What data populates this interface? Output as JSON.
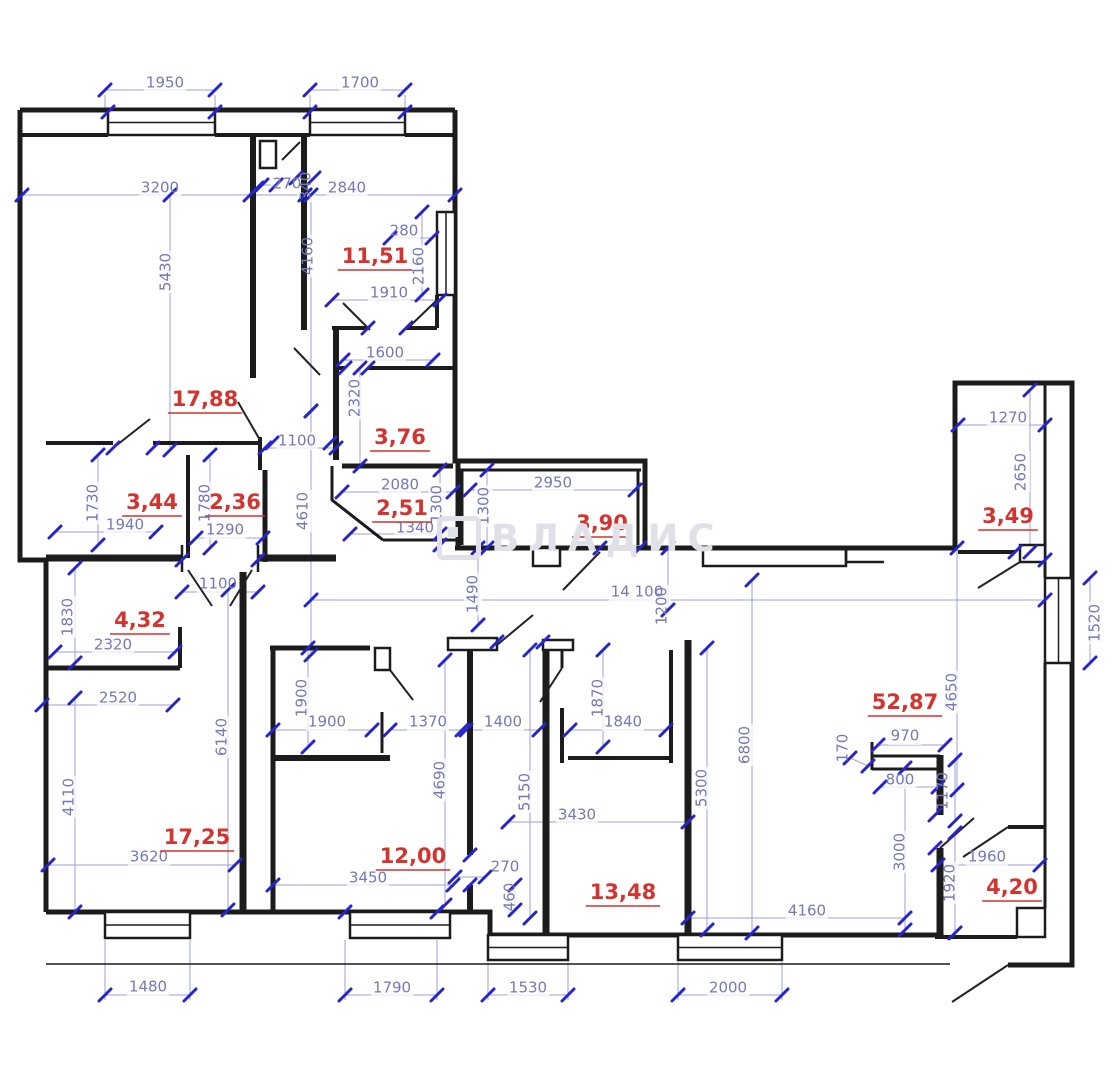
{
  "meta": {
    "watermark": "ВЛАДИС"
  },
  "plan": {
    "colors": {
      "wall": "#1c1c1c",
      "dim_line": "#9aa0d6",
      "tick": "#2525cb",
      "dim_text": "#7478b8",
      "area_text": "#d2342f",
      "watermark": "#dfe0e8"
    },
    "area_labels": [
      {
        "t": "17,88",
        "x": 205,
        "y": 400
      },
      {
        "t": "11,51",
        "x": 375,
        "y": 257
      },
      {
        "t": "3,76",
        "x": 400,
        "y": 438
      },
      {
        "t": "2,51",
        "x": 402,
        "y": 509
      },
      {
        "t": "3,90",
        "x": 602,
        "y": 524
      },
      {
        "t": "3,44",
        "x": 152,
        "y": 503
      },
      {
        "t": "2,36",
        "x": 235,
        "y": 503
      },
      {
        "t": "3,49",
        "x": 1008,
        "y": 517
      },
      {
        "t": "4,32",
        "x": 140,
        "y": 621
      },
      {
        "t": "17,25",
        "x": 197,
        "y": 838
      },
      {
        "t": "12,00",
        "x": 413,
        "y": 857
      },
      {
        "t": "13,48",
        "x": 623,
        "y": 893
      },
      {
        "t": "52,87",
        "x": 905,
        "y": 703
      },
      {
        "t": "4,20",
        "x": 1012,
        "y": 888
      }
    ],
    "dim_labels": [
      {
        "t": "1950",
        "x": 165,
        "y": 83,
        "r": 0
      },
      {
        "t": "1700",
        "x": 360,
        "y": 83,
        "r": 0
      },
      {
        "t": "3200",
        "x": 160,
        "y": 188,
        "r": 0
      },
      {
        "t": "270",
        "x": 287,
        "y": 184,
        "r": 0
      },
      {
        "t": "340",
        "x": 306,
        "y": 186,
        "r": -90
      },
      {
        "t": "2840",
        "x": 347,
        "y": 188,
        "r": 0
      },
      {
        "t": "280",
        "x": 404,
        "y": 231,
        "r": 0
      },
      {
        "t": "2160",
        "x": 419,
        "y": 266,
        "r": -90
      },
      {
        "t": "1910",
        "x": 389,
        "y": 293,
        "r": 0
      },
      {
        "t": "5430",
        "x": 166,
        "y": 272,
        "r": -90
      },
      {
        "t": "4160",
        "x": 308,
        "y": 256,
        "r": -90
      },
      {
        "t": "1600",
        "x": 385,
        "y": 353,
        "r": 0
      },
      {
        "t": "2320",
        "x": 355,
        "y": 398,
        "r": -90
      },
      {
        "t": "1100",
        "x": 297,
        "y": 441,
        "r": 0
      },
      {
        "t": "4610",
        "x": 303,
        "y": 511,
        "r": -90
      },
      {
        "t": "2080",
        "x": 400,
        "y": 485,
        "r": 0
      },
      {
        "t": "1300",
        "x": 437,
        "y": 504,
        "r": -90
      },
      {
        "t": "1300",
        "x": 484,
        "y": 506,
        "r": -90
      },
      {
        "t": "1340",
        "x": 415,
        "y": 528,
        "r": 0
      },
      {
        "t": "2950",
        "x": 553,
        "y": 483,
        "r": 0
      },
      {
        "t": "1270",
        "x": 1008,
        "y": 418,
        "r": 0
      },
      {
        "t": "2650",
        "x": 1021,
        "y": 472,
        "r": -90
      },
      {
        "t": "14 100",
        "x": 637,
        "y": 592,
        "r": 0
      },
      {
        "t": "1200",
        "x": 662,
        "y": 606,
        "r": -90
      },
      {
        "t": "1520",
        "x": 1095,
        "y": 623,
        "r": -90
      },
      {
        "t": "1100",
        "x": 218,
        "y": 584,
        "r": 0
      },
      {
        "t": "1490",
        "x": 473,
        "y": 594,
        "r": -90
      },
      {
        "t": "1830",
        "x": 68,
        "y": 617,
        "r": -90
      },
      {
        "t": "2320",
        "x": 113,
        "y": 645,
        "r": 0
      },
      {
        "t": "2520",
        "x": 118,
        "y": 698,
        "r": 0
      },
      {
        "t": "6140",
        "x": 222,
        "y": 737,
        "r": -90
      },
      {
        "t": "4110",
        "x": 69,
        "y": 797,
        "r": -90
      },
      {
        "t": "3620",
        "x": 149,
        "y": 857,
        "r": 0
      },
      {
        "t": "1480",
        "x": 148,
        "y": 987,
        "r": 0
      },
      {
        "t": "1900",
        "x": 302,
        "y": 698,
        "r": -90
      },
      {
        "t": "1900",
        "x": 327,
        "y": 722,
        "r": 0
      },
      {
        "t": "1370",
        "x": 428,
        "y": 722,
        "r": 0
      },
      {
        "t": "1400",
        "x": 503,
        "y": 722,
        "r": 0
      },
      {
        "t": "4690",
        "x": 440,
        "y": 780,
        "r": -90
      },
      {
        "t": "3450",
        "x": 368,
        "y": 878,
        "r": 0
      },
      {
        "t": "270",
        "x": 505,
        "y": 867,
        "r": 0
      },
      {
        "t": "460",
        "x": 510,
        "y": 897,
        "r": -90
      },
      {
        "t": "1870",
        "x": 598,
        "y": 698,
        "r": -90
      },
      {
        "t": "1840",
        "x": 623,
        "y": 722,
        "r": 0
      },
      {
        "t": "5150",
        "x": 525,
        "y": 792,
        "r": -90
      },
      {
        "t": "3430",
        "x": 577,
        "y": 815,
        "r": 0
      },
      {
        "t": "5300",
        "x": 702,
        "y": 788,
        "r": -90
      },
      {
        "t": "6800",
        "x": 745,
        "y": 745,
        "r": -90
      },
      {
        "t": "4650",
        "x": 952,
        "y": 692,
        "r": -90
      },
      {
        "t": "970",
        "x": 905,
        "y": 736,
        "r": 0
      },
      {
        "t": "170",
        "x": 843,
        "y": 748,
        "r": -90
      },
      {
        "t": "800",
        "x": 900,
        "y": 780,
        "r": 0
      },
      {
        "t": "1170",
        "x": 943,
        "y": 791,
        "r": -90
      },
      {
        "t": "3000",
        "x": 900,
        "y": 852,
        "r": -90
      },
      {
        "t": "1920",
        "x": 950,
        "y": 883,
        "r": -90
      },
      {
        "t": "4160",
        "x": 807,
        "y": 911,
        "r": 0
      },
      {
        "t": "1960",
        "x": 987,
        "y": 857,
        "r": 0
      },
      {
        "t": "1790",
        "x": 392,
        "y": 988,
        "r": 0
      },
      {
        "t": "1530",
        "x": 528,
        "y": 988,
        "r": 0
      },
      {
        "t": "2000",
        "x": 728,
        "y": 988,
        "r": 0
      },
      {
        "t": "1730",
        "x": 93,
        "y": 503,
        "r": -90
      },
      {
        "t": "1940",
        "x": 125,
        "y": 525,
        "r": 0
      },
      {
        "t": "1780",
        "x": 205,
        "y": 503,
        "r": -90
      },
      {
        "t": "1290",
        "x": 225,
        "y": 530,
        "r": 0
      }
    ]
  }
}
